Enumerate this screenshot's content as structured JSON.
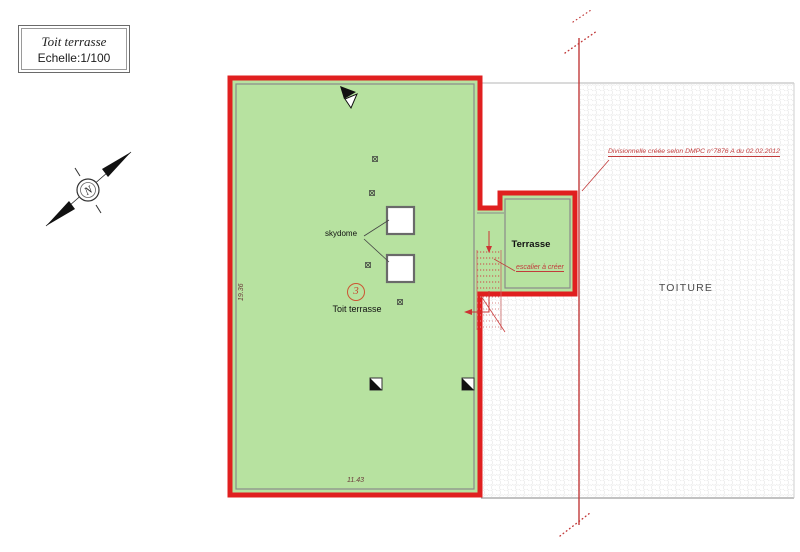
{
  "title_block": {
    "title": "Toit terrasse",
    "scale": "Echelle:1/100"
  },
  "compass": {
    "label": "N"
  },
  "main_area": {
    "label": "Toit terrasse",
    "lot_number": "3",
    "skydome_label": "skydome",
    "dim_height": "19.36",
    "dim_width": "11.43"
  },
  "terrace": {
    "label": "Terrasse",
    "stair_note": "escalier à créer"
  },
  "roof": {
    "label": "TOITURE"
  },
  "annotation": {
    "text": "Divisionnelle créée selon DMPC n°7876 A du 02.02.2012"
  },
  "colors": {
    "area_fill": "#b7e2a0",
    "boundary_red": "#e01f1f",
    "annotation_red": "#c23b3b",
    "inner_line": "#8a8a8a"
  }
}
